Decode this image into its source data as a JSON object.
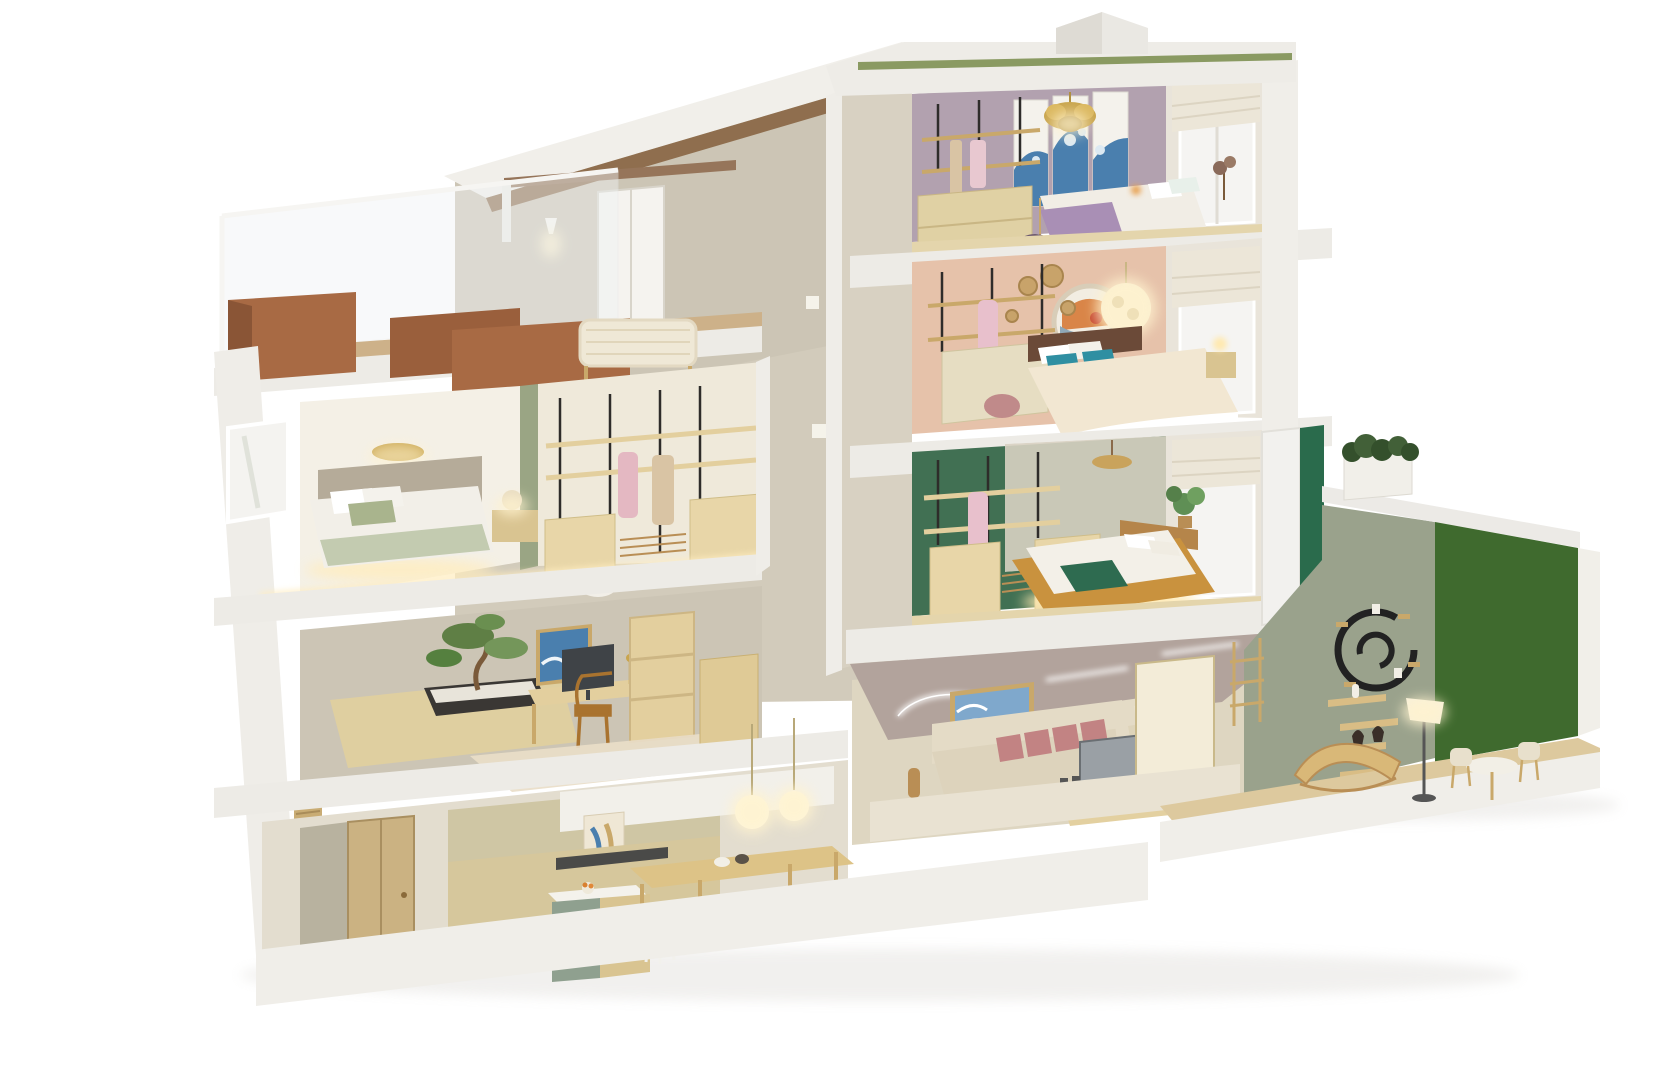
{
  "scene": {
    "description": "3D cutaway dollhouse render of a five-level Japandi townhouse, section view on a white background",
    "roof": {
      "features": [
        "green-sedum-strip",
        "pyramid-skylight",
        "white-parapet"
      ]
    },
    "levels": [
      {
        "name": "level-4",
        "rooms": [
          {
            "name": "lavender-bedroom",
            "features": [
              "great-wave-triptych",
              "gold-flower-chandelier",
              "open-wardrobe-rack",
              "double-bed-lavender-throw",
              "roman-shade-window",
              "glass-balcony"
            ]
          },
          {
            "name": "roof-terrace",
            "features": [
              "wood-planters",
              "red-bush",
              "purple-flowers",
              "white-flowers",
              "rattan-bench",
              "pergola-beam",
              "wall-sconce",
              "terrace-door",
              "glass-railing",
              "sloped-roof"
            ]
          }
        ]
      },
      {
        "name": "level-3",
        "rooms": [
          {
            "name": "peach-bedroom",
            "features": [
              "round-koi-artwork",
              "glowing-globe-pendant",
              "woven-wall-baskets",
              "bed-teal-pillows",
              "striped-duvet",
              "open-wardrobe-rack",
              "roman-shade-window"
            ]
          },
          {
            "name": "eucalyptus-bedroom",
            "features": [
              "leaf-wallpaper",
              "gold-disc-light",
              "bed-sage-bedding",
              "nightstand-lamp",
              "walk-in-closet",
              "hanging-clothes",
              "white-pouf"
            ]
          }
        ]
      },
      {
        "name": "level-2",
        "rooms": [
          {
            "name": "green-bedroom",
            "features": [
              "bamboo-mural-wall",
              "low-platform-bed-underglow",
              "green-throw",
              "open-wardrobe-rack",
              "corner-plant",
              "wood-pendant",
              "green-door-panel"
            ]
          },
          {
            "name": "home-office",
            "features": [
              "bonsai-on-platform",
              "wave-artwork",
              "desk-with-monitor",
              "wood-chair",
              "bookshelf",
              "cream-rug"
            ]
          }
        ]
      },
      {
        "name": "level-1",
        "rooms": [
          {
            "name": "living-room",
            "features": [
              "cream-sofa-blush-pillows",
              "wave-artwork",
              "tv-on-wood-console",
              "shoji-screen",
              "led-ceiling-ring",
              "pouf"
            ]
          },
          {
            "name": "kitchen-dining",
            "features": [
              "entry-door",
              "sage-kitchen-island",
              "bar-stool",
              "dark-cooktop",
              "long-dining-table",
              "sage-chairs",
              "glowing-pendant-globes",
              "bookshelf-wall",
              "shutter-panel"
            ]
          },
          {
            "name": "garden-lounge",
            "features": [
              "sage-feature-wall",
              "spiral-wall-shelf",
              "zigzag-shelves",
              "curved-lounge-chair",
              "floor-lamp",
              "vertical-garden-red-blooms",
              "cafe-table-chairs",
              "roof-planter-shrubs"
            ]
          }
        ]
      }
    ],
    "circulation": {
      "name": "central-staircase",
      "features": [
        "dark-steel-stringers",
        "open-treads",
        "glass-balustrades",
        "four-flights",
        "wall-lights"
      ]
    }
  },
  "palette": {
    "background": "#ffffff",
    "cut_wall_white": "#edebe6",
    "structure_white": "#f0eee9",
    "interior_beige": "#d2cbbb",
    "wall_cream": "#e9e4da",
    "wood_light": "#e3d0a0",
    "wood_floor": "#e4d5ac",
    "wood_deck": "#cdb189",
    "wood_mid": "#c9a86a",
    "planter_wood": "#a86a44",
    "stair_steel": "#4b4a46",
    "lavender_wall": "#b2a1af",
    "peach_wall": "#e6c2aa",
    "green_wall": "#417053",
    "green_door": "#2a6b4c",
    "sage_wall": "#9aa28c",
    "sage_divider": "#9aa584",
    "leaf_green": "#a8b28c",
    "garden_green": "#3f6a2e",
    "garden_red": "#cc3b2b",
    "sedum_green": "#72834a",
    "teal_pillow": "#2f8fa2",
    "blush_pillow": "#c28383",
    "stripe_orange": "#dfa055",
    "art_blue": "#4a7fae",
    "art_blue_light": "#7fa8cc",
    "gold": "#c9a54e",
    "chair_sage": "#b9c4ae",
    "glow": "#fff3cf",
    "ceiling_mauve": "#b2a39c",
    "sofa_cream": "#ddd3bc"
  }
}
